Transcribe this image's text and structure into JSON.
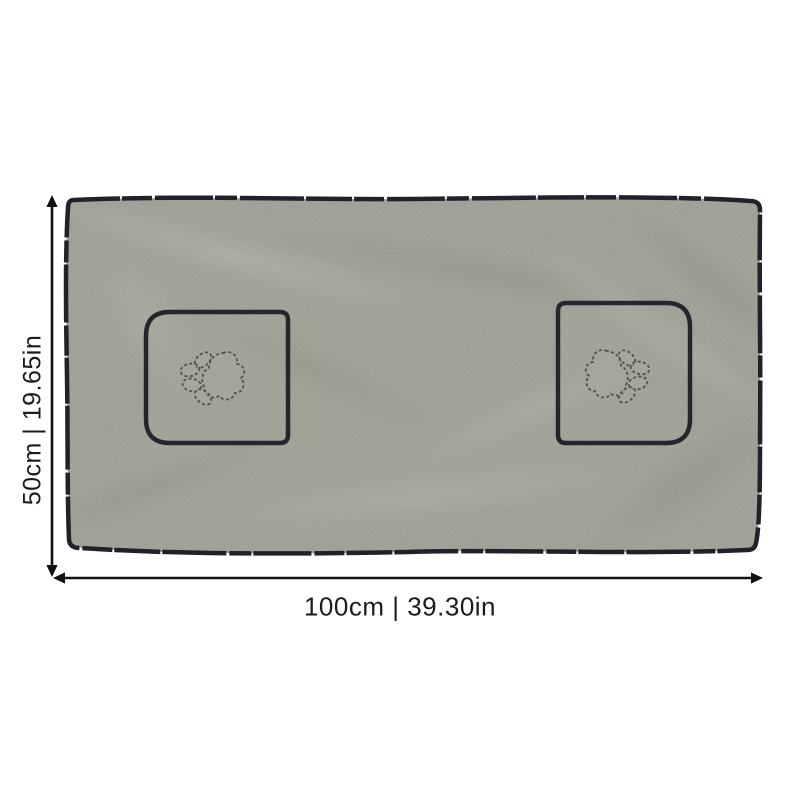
{
  "figure": {
    "type": "product-dimension-diagram",
    "background": "#ffffff",
    "subject": "pet drying towel with paw-print pockets"
  },
  "dimensions": {
    "height_label": "50cm | 19.65in",
    "width_label": "100cm | 39.30in"
  },
  "towel": {
    "pocket_count": 2,
    "motif": "paw-print",
    "fabric_color": "#989a8f",
    "edge_trim_color": "#20222a",
    "stitch_color": "#51534a"
  },
  "annotation_style": {
    "arrow_color": "#111111",
    "label_color": "#1b1b1b"
  }
}
